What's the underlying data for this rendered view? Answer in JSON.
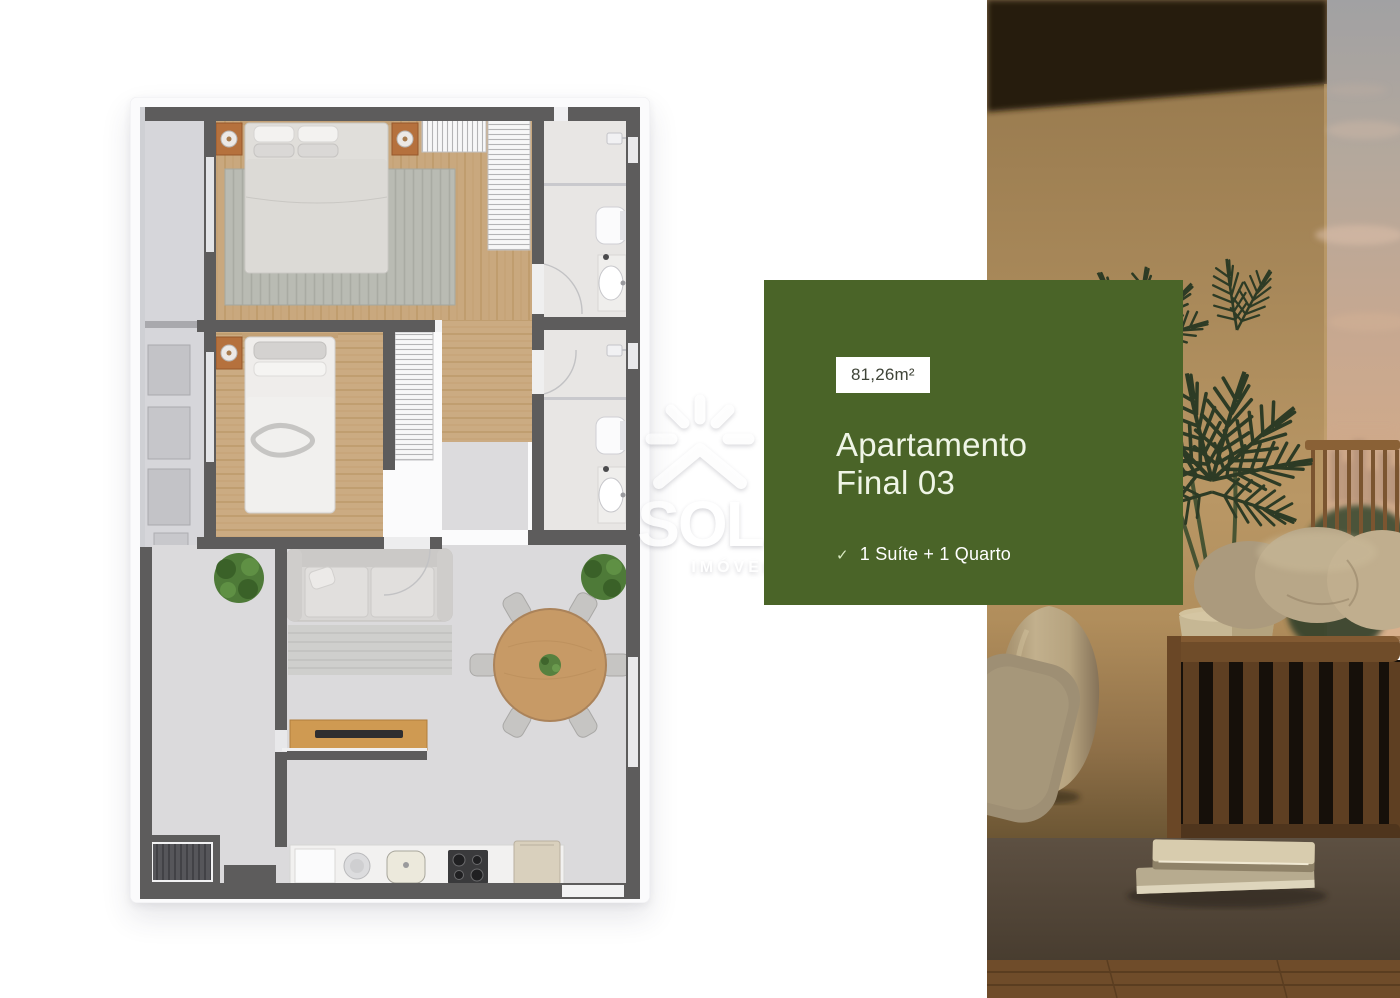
{
  "card": {
    "area": "81,26m²",
    "title_line1": "Apartamento",
    "title_line2": "Final 03",
    "features": [
      {
        "icon": "check-icon",
        "glyph": "✓",
        "label": "1 Suíte + 1 Quarto"
      }
    ]
  },
  "watermark": {
    "brand": "SOL",
    "tagline": "IMÓVEIS"
  },
  "colors": {
    "card_green": "#4a6428",
    "badge_background": "#ffffff",
    "badge_text": "#3f4438",
    "plan_wall_gray": "#5d5c5c",
    "plan_wood": "#c9a87e",
    "plan_tile": "#dbdadc",
    "photo_wall_tan": "#b99765",
    "photo_sky_pink": "#d0aa8a",
    "palm_green": "#2d3b25"
  }
}
